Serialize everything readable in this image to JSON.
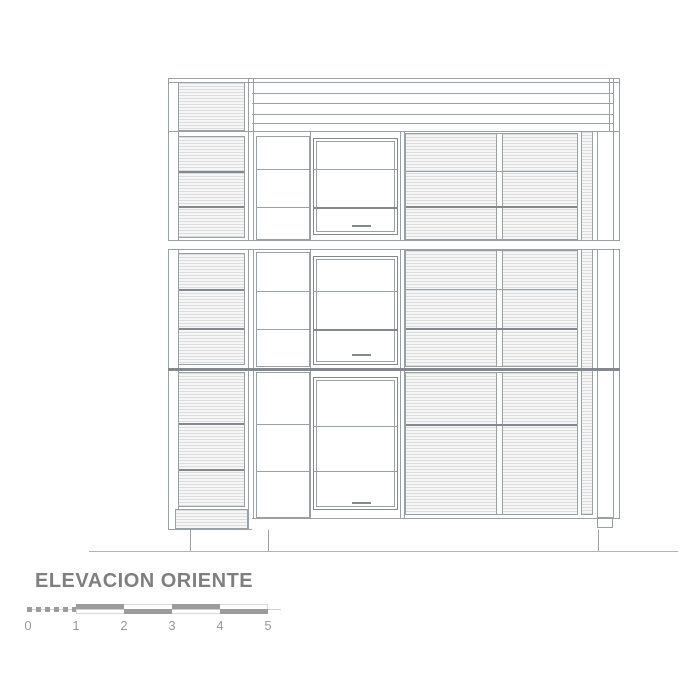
{
  "drawing": {
    "title": "ELEVACION ORIENTE"
  },
  "scale_bar": {
    "labels": [
      "0",
      "1",
      "2",
      "3",
      "4",
      "5"
    ]
  },
  "colors": {
    "line": "#9aa0a4",
    "line_dark": "#85898d",
    "hatch_line": "#dcdcdc",
    "hatch_bg": "#f6f6f6",
    "text": "#7f7f7f",
    "bar_fill": "#9c9c9c",
    "bar_outline": "#d8d8d8",
    "ground": "#b3b3b3",
    "background": "#ffffff"
  }
}
